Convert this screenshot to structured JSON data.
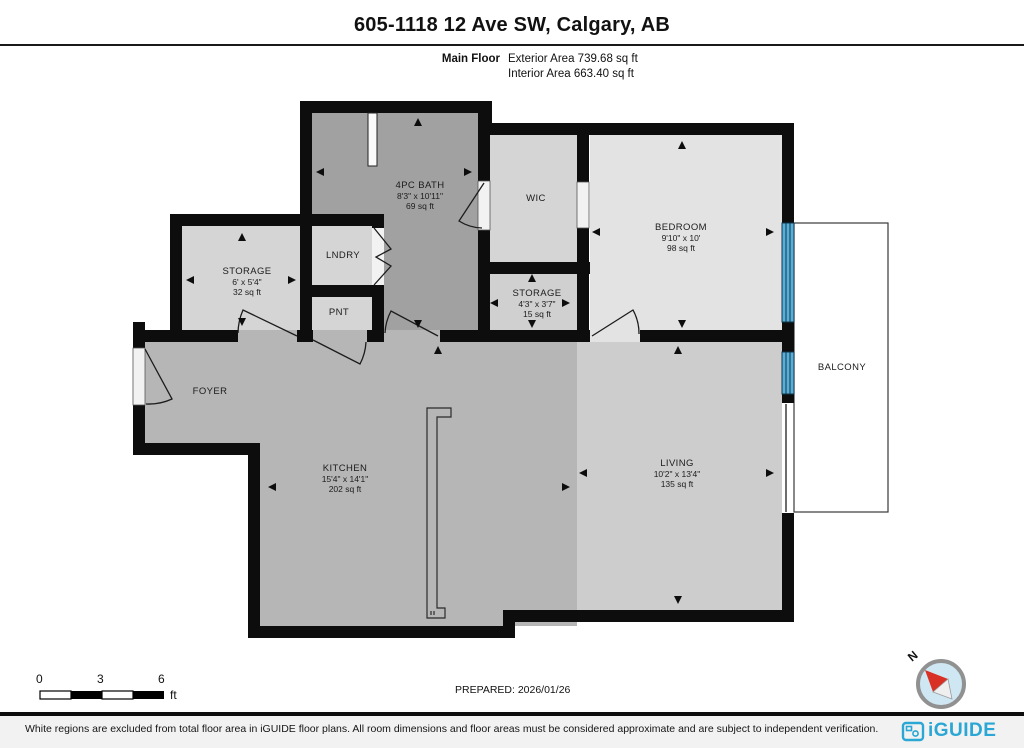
{
  "header": {
    "title": "605-1118 12 Ave SW, Calgary, AB",
    "floor_label": "Main Floor",
    "exterior_area": "Exterior Area 739.68 sq ft",
    "interior_area": "Interior Area 663.40 sq ft"
  },
  "rooms": {
    "bath": {
      "name": "4PC BATH",
      "dims": "8'3\" x 10'11\"",
      "area": "69 sq ft"
    },
    "wic": {
      "name": "WIC"
    },
    "bedroom": {
      "name": "BEDROOM",
      "dims": "9'10\" x 10'",
      "area": "98 sq ft"
    },
    "storage_left": {
      "name": "STORAGE",
      "dims": "6' x 5'4\"",
      "area": "32 sq ft"
    },
    "laundry": {
      "name": "LNDRY"
    },
    "pantry": {
      "name": "PNT"
    },
    "storage_mid": {
      "name": "STORAGE",
      "dims": "4'3\" x 3'7\"",
      "area": "15 sq ft"
    },
    "foyer": {
      "name": "FOYER"
    },
    "kitchen": {
      "name": "KITCHEN",
      "dims": "15'4\" x 14'1\"",
      "area": "202 sq ft"
    },
    "living": {
      "name": "LIVING",
      "dims": "10'2\" x 13'4\"",
      "area": "135 sq ft"
    },
    "balcony": {
      "name": "BALCONY"
    }
  },
  "scale_bar": {
    "tick0": "0",
    "tick3": "3",
    "tick6": "6",
    "unit": "ft"
  },
  "prepared_label": "PREPARED: 2026/01/26",
  "compass": {
    "north_label": "N"
  },
  "footer": {
    "disclaimer": "White regions are excluded from total floor area in iGUIDE floor plans. All room dimensions and floor areas must be considered approximate and are subject to independent verification.",
    "brand": "iGUIDE"
  },
  "colors": {
    "wall": "#0d0d0d",
    "bath": "#a1a1a1",
    "kitchen": "#b6b6b6",
    "living": "#cdcdcd",
    "bedroom": "#e3e3e3",
    "closet": "#d5d5d5",
    "closet_dark": "#d0d0d0",
    "window": "#58aed6",
    "balcony": "#ffffff",
    "brand": "#2aa7d4",
    "needle_red": "#d93025"
  }
}
